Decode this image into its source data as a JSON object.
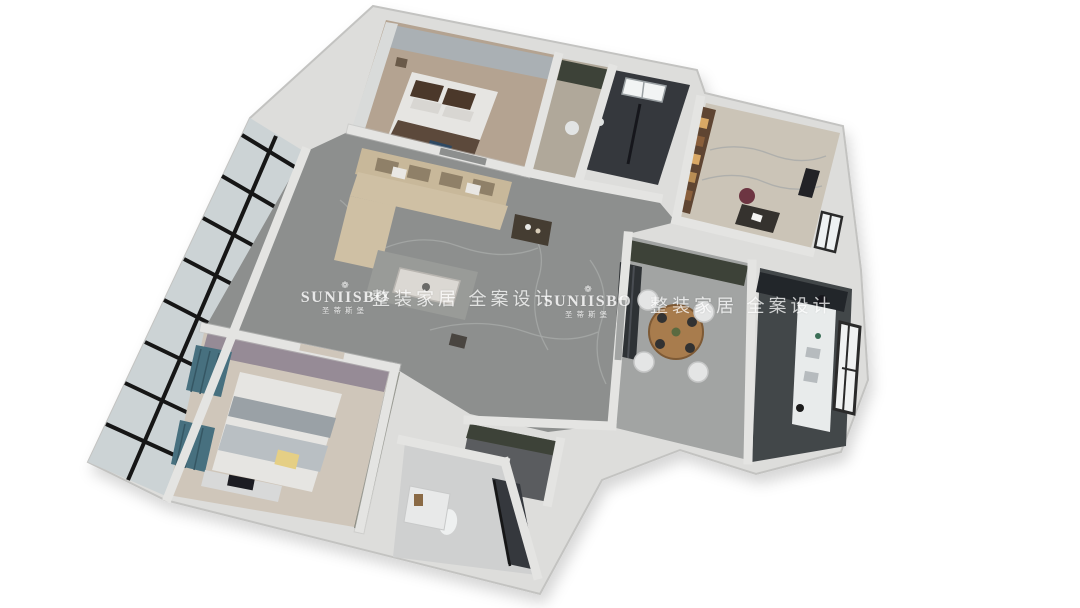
{
  "watermark": {
    "brand": "SUNIISBO",
    "brand_cn": "圣蒂斯堡",
    "tagline": "整装家居 全案设计",
    "ornament_glyph": "❁",
    "color": "#ffffff"
  },
  "palette": {
    "bg": "#ffffff",
    "wall": "#e4e4e2",
    "wall-shadow": "#c3c3c1",
    "slab": "#dddddb",
    "marble": "#8d8f8e",
    "marble-vein": "#a8aaa9",
    "wood": "#b4a391",
    "wood-light": "#cfc6ba",
    "tile-dark": "#36393e",
    "kitchen-floor": "#43464a",
    "dining-floor": "#a2a4a3",
    "carpet": "#cbc4b7",
    "glass": "#ccd3d5",
    "grid-black": "#161616",
    "sofa": "#c8b89a",
    "bed-brown": "#5c483a",
    "bed-white": "#e6e5e2",
    "teal": "#46707f",
    "purple": "#968b96",
    "yellow": "#e5cf85",
    "maroon": "#6d3642",
    "shelf-warm": "#5e4430",
    "table-wood": "#a87b4e",
    "counter-white": "#e8ebeb",
    "olive": "#3e4237",
    "watermark": "#ffffff"
  }
}
